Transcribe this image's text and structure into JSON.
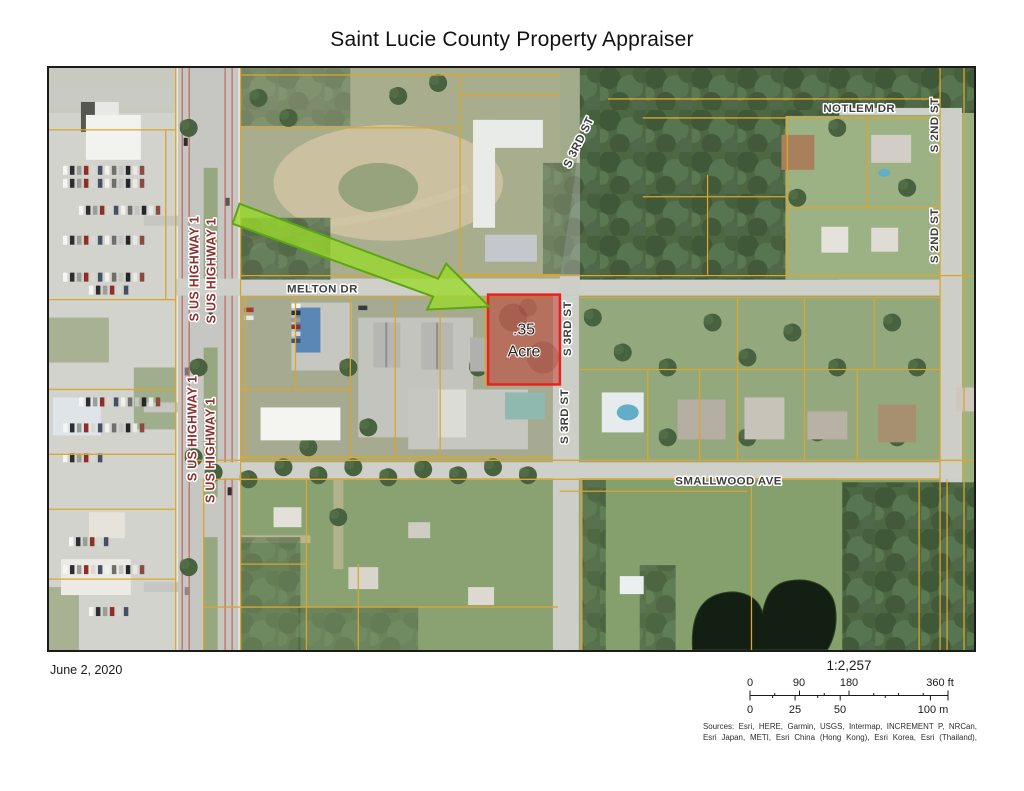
{
  "title": "Saint Lucie County Property Appraiser",
  "map": {
    "parcel": {
      "area_line1": ".35",
      "area_line2": "Acre"
    },
    "streets": {
      "highway": "S US HIGHWAY 1",
      "melton": "MELTON DR",
      "notlem": "NOTLEM DR",
      "third": "S 3RD ST",
      "second": "S 2ND ST",
      "smallwood": "SMALLWOOD AVE"
    },
    "colors": {
      "parcel_outline": "#e8231d",
      "parcel_fill": "rgba(198,62,48,0.52)",
      "arrow_fill": "rgba(154,218,44,0.78)",
      "arrow_stroke": "#5ca514",
      "parcel_lines": "#d9a62e",
      "highway_label": "#8b3030",
      "street_label": "#3d3d3d"
    }
  },
  "footer": {
    "date": "June 2, 2020",
    "scale_ratio": "1:2,257",
    "ft_labels": [
      "0",
      "90",
      "180",
      "360 ft"
    ],
    "m_labels": [
      "0",
      "25",
      "50",
      "100 m"
    ],
    "sources_line1": "Sources: Esri, HERE, Garmin, USGS, Intermap, INCREMENT P, NRCan,",
    "sources_line2": "Esri Japan, METI, Esri China (Hong Kong), Esri Korea, Esri (Thailand),"
  }
}
